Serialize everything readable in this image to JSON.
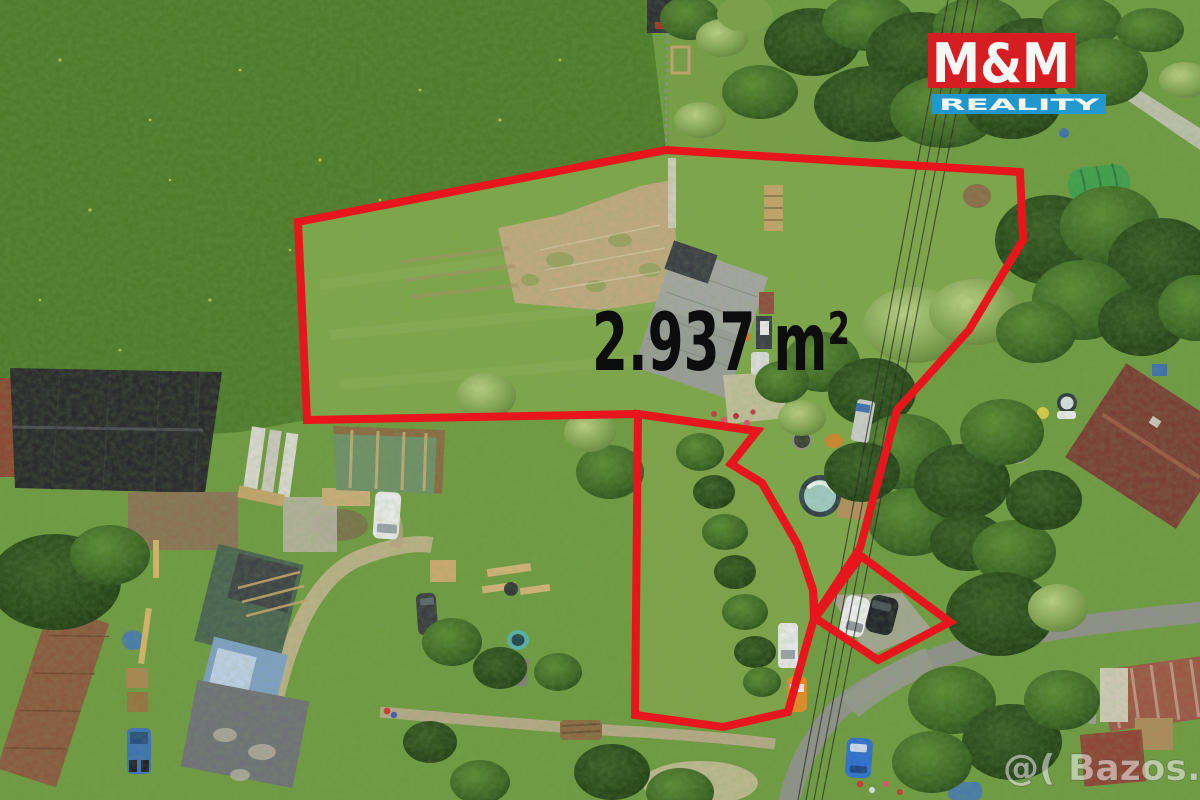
{
  "image_size": {
    "width": 1200,
    "height": 800
  },
  "overlay": {
    "area_label": "2.937 m²",
    "area_label_color": "#0d0d0d",
    "boundary_color": "#e8151c",
    "parcels": {
      "main": "298,222 666,150 1020,172 1023,240 969,330 897,410 860,548 814,618 813,590 798,545 762,483 731,464 757,431 637,414 307,420",
      "strip": "638,414 757,431 731,464 762,483 798,545 813,590 815,615 803,657 788,712 723,727 635,715",
      "driveway": "861,556 950,622 878,660 815,618"
    }
  },
  "logo": {
    "line_top": "M&M",
    "line_bottom": "REALITY",
    "top_bg": "#dc1b22",
    "bottom_bg": "#1f9ad6",
    "text_color": "#ffffff"
  },
  "watermark": {
    "text": "@( Bazos.cz"
  },
  "photo_palette": {
    "grass": "#6f9a42",
    "meadow": "#4f7c2c",
    "parcel_grass": "#8cb052",
    "road": "#8e9089",
    "dirt": "#bfa87e",
    "tree_dark": "#2f5520"
  }
}
